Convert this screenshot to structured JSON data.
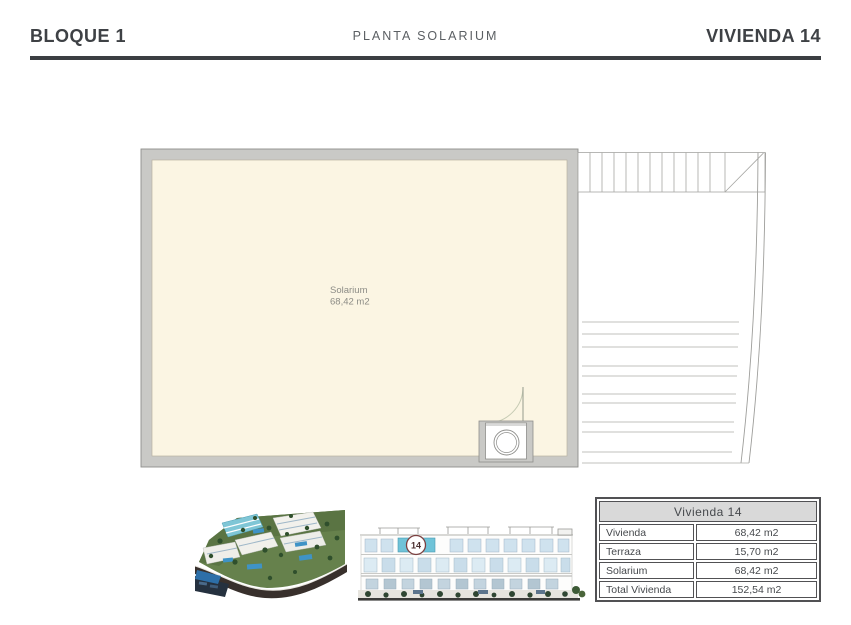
{
  "header": {
    "block_title": "BLOQUE 1",
    "plan_title": "PLANTA SOLARIUM",
    "unit_title": "VIVIENDA 14"
  },
  "floor_plan": {
    "room_name": "Solarium",
    "room_area": "68,42 m2"
  },
  "elevation": {
    "unit_badge": "14"
  },
  "summary_table": {
    "title": "Vivienda 14",
    "rows": [
      {
        "label": "Vivienda",
        "value": "68,42 m2"
      },
      {
        "label": "Terraza",
        "value": "15,70 m2"
      },
      {
        "label": "Solarium",
        "value": "68,42 m2"
      },
      {
        "label": "Total Vivienda",
        "value": "152,54 m2"
      }
    ]
  },
  "colors": {
    "floor_fill": "#FBF5E3",
    "wall_gray": "#C9C9C6",
    "wall_edge": "#8E8E8B",
    "stair_line": "#A8A8A5",
    "highlight_teal": "#6FC3D8",
    "badge_ring": "#7B4040",
    "header_rule": "#3B3E42"
  }
}
